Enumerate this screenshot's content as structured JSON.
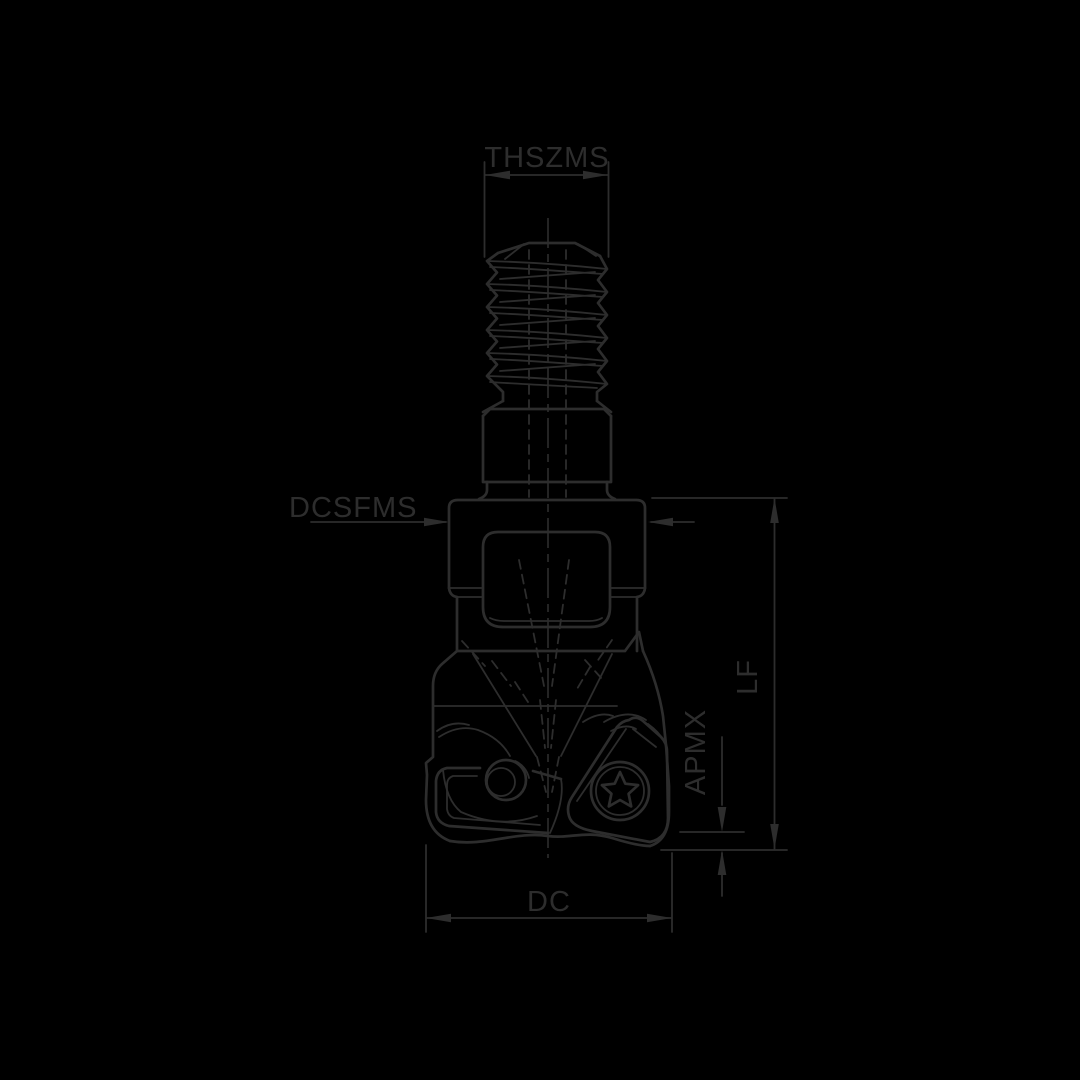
{
  "title": "Indexable end mill technical drawing",
  "colors": {
    "background": "#000000",
    "ink": "#2d2d2d"
  },
  "labels": {
    "thread_size": "THSZMS",
    "shank_diameter": "DCSFMS",
    "functional_length": "LF",
    "max_depth_of_cut": "APMX",
    "cutting_diameter": "DC"
  }
}
